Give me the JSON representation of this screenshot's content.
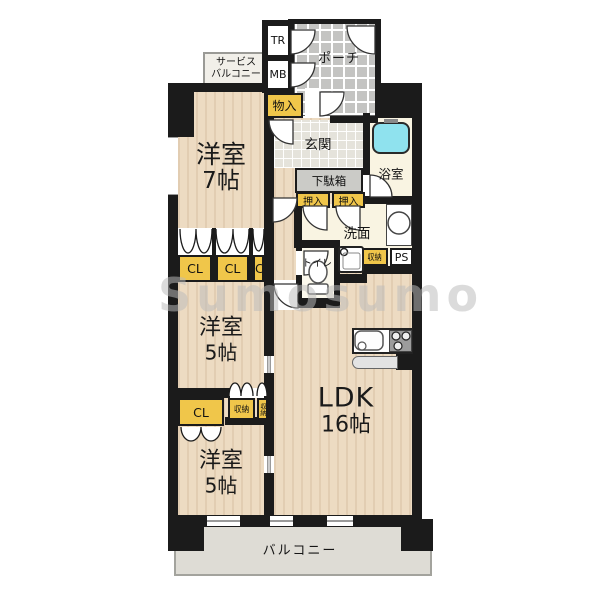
{
  "watermark": "Sumosumo",
  "colors": {
    "wall": "#1b1b1b",
    "wood_floor": "#eddbc2",
    "service_floor": "#f9f4e2",
    "storage_yellow": "#f0c64a",
    "porch_tile": "#c4c4c2",
    "genkan_tile": "#e5e3db",
    "balcony_gray": "#dedcd5",
    "bathtub_cyan": "#8fe2ee",
    "cabinet_gray": "#cbcbc7"
  },
  "rooms": {
    "service_balcony": {
      "line1": "サービス",
      "line2": "バルコニー"
    },
    "trunk": "TR",
    "meter_box": "MB",
    "porch": "ポーチ",
    "storage_entry": "物入",
    "entrance": "玄関",
    "bathroom": "浴室",
    "shoe_cabinet": "下駄箱",
    "oshiire_left": "押入",
    "oshiire_right": "押入",
    "washroom": "洗面",
    "toilet": "トイレ",
    "storage_wash": "収納",
    "pipe_space": "PS",
    "room7": {
      "name": "洋室",
      "size": "7帖"
    },
    "cl1": "CL",
    "cl2": "CL",
    "cl3": "CL",
    "cl4": "CL",
    "room5_middle": {
      "name": "洋室",
      "size": "5帖"
    },
    "storage_b1": "収納",
    "storage_b2": "収納",
    "room5_bottom": {
      "name": "洋室",
      "size": "5帖"
    },
    "ldk": {
      "name": "LDK",
      "size": "16帖"
    },
    "balcony": "バルコニー"
  }
}
